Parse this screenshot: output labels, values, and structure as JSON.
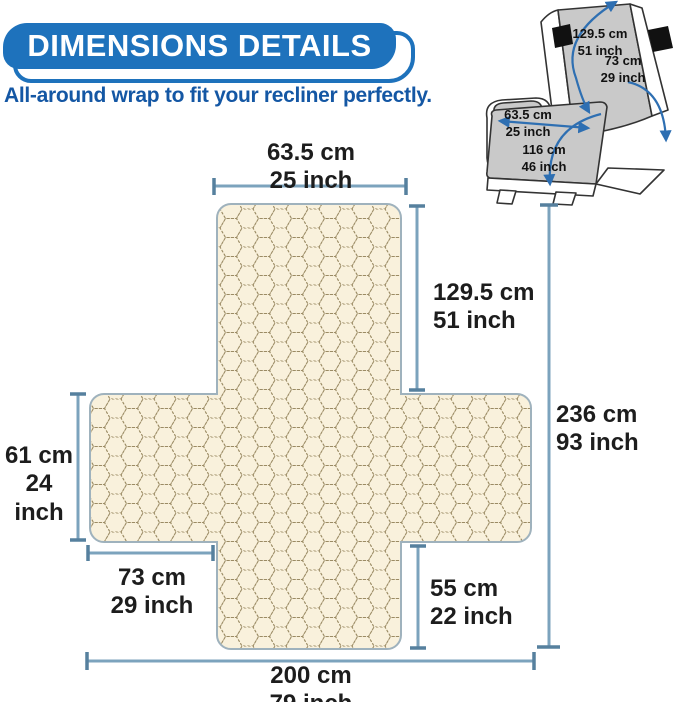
{
  "header": {
    "title": "DIMENSIONS DETAILS",
    "subtitle": "All-around wrap to fit your recliner perfectly."
  },
  "colors": {
    "badge_blue": "#1e72bc",
    "subtitle_blue": "#1457a4",
    "dimension_line_blue": "#7ca3bd",
    "dimension_tick_blue": "#56809e",
    "fabric_cream": "#f9f1dc",
    "fabric_stitch_tan": "#9b8b64",
    "shape_outline": "#9fb2bd",
    "cover_gray": "#c9c9c9",
    "arrow_blue": "#2e6fb2",
    "label_text": "#1d1d1d"
  },
  "cover_diagram": {
    "measurements": [
      {
        "id": "seat-width-top",
        "cm": "63.5 cm",
        "inch": "25 inch"
      },
      {
        "id": "back-height",
        "cm": "129.5 cm",
        "inch": "51 inch"
      },
      {
        "id": "total-length",
        "cm": "236 cm",
        "inch": "93 inch"
      },
      {
        "id": "side-wing-height",
        "cm": "61 cm",
        "inch": "24 inch"
      },
      {
        "id": "side-wing-width",
        "cm": "73 cm",
        "inch": "29 inch"
      },
      {
        "id": "front-drop",
        "cm": "55 cm",
        "inch": "22 inch"
      },
      {
        "id": "total-width",
        "cm": "200 cm",
        "inch": "79 inch"
      }
    ]
  },
  "recliner_diagram": {
    "measurements": [
      {
        "id": "back-wrap",
        "cm": "129.5 cm",
        "inch": "51 inch"
      },
      {
        "id": "arm-wrap",
        "cm": "73 cm",
        "inch": "29 inch"
      },
      {
        "id": "seat-width",
        "cm": "63.5 cm",
        "inch": "25 inch"
      },
      {
        "id": "seat-length",
        "cm": "116 cm",
        "inch": "46 inch"
      }
    ]
  }
}
